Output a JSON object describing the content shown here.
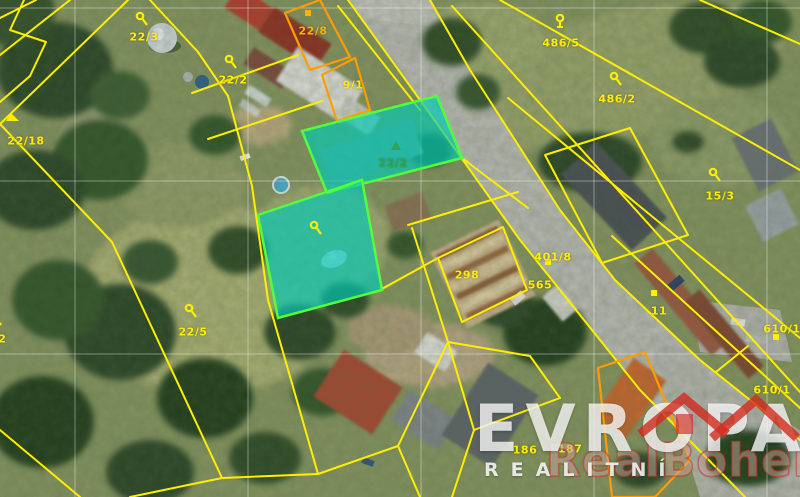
{
  "map": {
    "description": "Aerial cadastral map with highlighted property parcel",
    "boundary_color": "#ffee00",
    "accent_boundary_color": "#ff9d00",
    "grid_color": "rgba(255,255,255,0.4)",
    "highlighted_parcel": {
      "label": "22/2",
      "fill": "#14c8b4",
      "border": "#52ff3d",
      "label_color": "#2ba84f"
    },
    "parcel_labels": [
      {
        "text": "22/8",
        "x": 313,
        "y": 31,
        "color": "#ffb300"
      },
      {
        "text": "9/1",
        "x": 353,
        "y": 85,
        "color": "#ffee00"
      },
      {
        "text": "22/2",
        "x": 233,
        "y": 80,
        "color": "#ffee00"
      },
      {
        "text": "22/3",
        "x": 144,
        "y": 37,
        "color": "#ffee00"
      },
      {
        "text": "22/18",
        "x": 26,
        "y": 141,
        "color": "#ffee00"
      },
      {
        "text": "22/5",
        "x": 193,
        "y": 332,
        "color": "#ffee00"
      },
      {
        "text": "9/2",
        "x": -4,
        "y": 339,
        "color": "#ffee00"
      },
      {
        "text": "486/5",
        "x": 561,
        "y": 43,
        "color": "#ffee00"
      },
      {
        "text": "486/2",
        "x": 617,
        "y": 99,
        "color": "#ffee00"
      },
      {
        "text": "15/3",
        "x": 720,
        "y": 196,
        "color": "#ffee00"
      },
      {
        "text": "610/18",
        "x": 786,
        "y": 329,
        "color": "#ffee00"
      },
      {
        "text": "610/1",
        "x": 772,
        "y": 390,
        "color": "#ffee00"
      },
      {
        "text": "401/8",
        "x": 553,
        "y": 257,
        "color": "#ffee00"
      },
      {
        "text": "565",
        "x": 540,
        "y": 285,
        "color": "#ffee00"
      },
      {
        "text": "298",
        "x": 467,
        "y": 275,
        "color": "#ffee00"
      },
      {
        "text": "11",
        "x": 659,
        "y": 311,
        "color": "#ffee00"
      },
      {
        "text": "186",
        "x": 525,
        "y": 450,
        "color": "#ffee00"
      },
      {
        "text": "187",
        "x": 570,
        "y": 449,
        "color": "#ffee00"
      },
      {
        "text": "22/2",
        "x": 393,
        "y": 163,
        "color": "#2ba84f"
      }
    ],
    "symbols": [
      {
        "type": "flag",
        "x": 231,
        "y": 62,
        "color": "#ffee00"
      },
      {
        "type": "flag",
        "x": 142,
        "y": 19,
        "color": "#ffee00"
      },
      {
        "type": "mound",
        "x": 12,
        "y": 119,
        "color": "#ffee00"
      },
      {
        "type": "flag",
        "x": 191,
        "y": 311,
        "color": "#ffee00"
      },
      {
        "type": "flag",
        "x": -4,
        "y": 319,
        "color": "#ffee00"
      },
      {
        "type": "tree",
        "x": 560,
        "y": 22,
        "color": "#ffee00"
      },
      {
        "type": "flag",
        "x": 616,
        "y": 79,
        "color": "#ffee00"
      },
      {
        "type": "flag",
        "x": 715,
        "y": 175,
        "color": "#ffee00"
      },
      {
        "type": "flag",
        "x": 316,
        "y": 228,
        "color": "#ffee00"
      },
      {
        "type": "dot",
        "x": 657,
        "y": 297,
        "color": "#ffee00"
      },
      {
        "type": "dot",
        "x": 311,
        "y": 17,
        "color": "#ffb300"
      },
      {
        "type": "dot",
        "x": 779,
        "y": 341,
        "color": "#ffee00"
      },
      {
        "type": "dot",
        "x": 551,
        "y": 266,
        "color": "#ffee00"
      },
      {
        "type": "tri",
        "x": 397,
        "y": 148,
        "color": "#2ba84f"
      }
    ]
  },
  "watermark": {
    "brand": "EVROPA",
    "tagline": "REALITNÍ",
    "overlay_text": "RealBohemia",
    "brand_color": "rgba(255,255,255,0.78)",
    "accent_color": "#d22a1e"
  }
}
